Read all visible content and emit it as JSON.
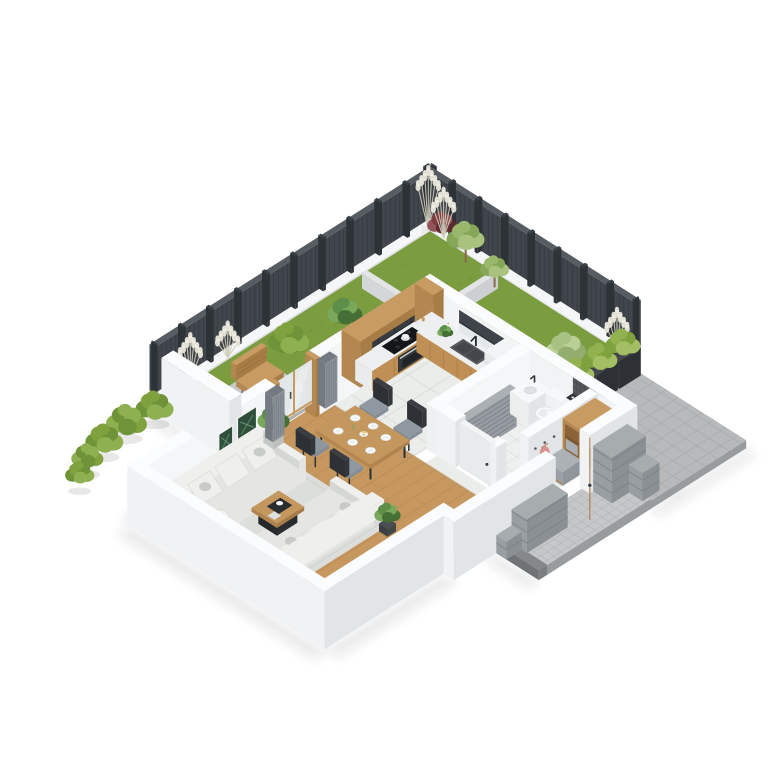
{
  "scene": {
    "description": "isometric-3d-floor-plan-render-of-apartment-with-garden",
    "background": "#ffffff"
  },
  "counts": {
    "fence_nw_posts": 10,
    "fence_ne_posts": 8,
    "garden_boundary_bushes": 5,
    "planter_boxes": 3,
    "dining_plates": 6,
    "dining_chairs": 4,
    "sofas": 2,
    "wall_art_frames": 4
  },
  "palette": {
    "bg": "#ffffff",
    "fenceFace": "#41464c",
    "fenceTop": "#575c62",
    "fencePost": "#2d3237",
    "fenceSlat": "#31363c",
    "curbTop": "#f5f6f7",
    "curbLeft": "#e8eaec",
    "curbRight": "#dbdee1",
    "grass": "#7c9c40",
    "grassDark": "#6d8c36",
    "edging": "#e2e4e6",
    "wallTop": "#fbfcfd",
    "wallLeft": "#f0f2f4",
    "wallRight": "#e2e5e8",
    "woodFloor": "#c6975f",
    "woodLine": "#b0814c",
    "tile": "#ebedeb",
    "tileLine": "#d9dbd8",
    "bathTile": "#eef0f0",
    "patio": "#b7b9bb",
    "patioLine": "#a8aaac",
    "patioSide": "#999c9f",
    "patioDark": "#84888b",
    "walkway": "#c5c7c9",
    "walkLine": "#b5b7b9",
    "wood": "#c89b63",
    "woodDark": "#b3874f",
    "woodDarker": "#a87c45",
    "woodFront": "#c08f55",
    "counterTop": "#edeff0",
    "cabinetDark": "#383c41",
    "cabinetLine": "#292d32",
    "glass": "#e3e9ea",
    "blind": "#3f444a",
    "mosaic": "#55595d",
    "mosaicLine": "#404448",
    "white": "#f7f8f9",
    "washerDoor": "#3b3f43",
    "washerRing": "#82878c",
    "radiator": "#979da2",
    "radiatorLine": "#7b8186",
    "rug": "#dcdedb",
    "rugLine": "#cfd1ce",
    "sofa": "#e5e6e4",
    "sofaLight": "#efefee",
    "sofaShade": "#d5d7d5",
    "cushion": "#c9cbc8",
    "tableWood": "#c4975f",
    "chairSeat": "#8f98a0",
    "chairDark": "#2d3135",
    "lampShade": "#f0f0ee",
    "lampWood": "#b08d5c",
    "greens": [
      "#5d8f4a",
      "#79a85b",
      "#466f36"
    ],
    "treeGreens": [
      "#9ab86b",
      "#86a758",
      "#a9c27e"
    ],
    "hedgeGreens": [
      "#92b14f",
      "#7fa23f",
      "#a4bf63"
    ],
    "bushGreens": [
      "#7fa23f",
      "#6e9338",
      "#8fb050"
    ],
    "paleShrub": [
      "#a8c284",
      "#b9cf96",
      "#93ad6e"
    ],
    "redShrub": [
      "#7e3b41",
      "#93555a",
      "#5f2b33"
    ],
    "pampas": "#e8e6d8",
    "pampasStem": "#cfccba",
    "artGreen": "#2f4f3b",
    "artLeaf": "#6d9a7c",
    "curtain": "#8a9097",
    "curtainDark": "#747a82",
    "doorWood": "#c5965c",
    "blockTop": "#a7acaf",
    "blockLeft": "#999ea2",
    "blockRight": "#8b9094",
    "blockLine": "#7c8185",
    "bag": "#d8918c",
    "bowlYellow": "#e4c768",
    "shadow": "rgba(50,55,60,0.10)"
  },
  "inventory": {
    "garden": [
      "slatted-privacy-fence",
      "lawn-strips",
      "pampas-grasses",
      "red-leaf-shrub",
      "garden-trees",
      "round-boxwood-bushes",
      "garden-bench",
      "paver-patch",
      "planter-boxes-with-hedge",
      "white-curb-wall"
    ],
    "kitchen": [
      "dark-upper-cabinets",
      "wood-cabinet-niche",
      "cooktop-with-pot",
      "oven",
      "sink-with-faucet",
      "window-with-roller-blind",
      "counter-plant",
      "tall-cabinet"
    ],
    "dining": [
      "wooden-dining-table",
      "chairs",
      "plates",
      "fruit-bowl"
    ],
    "living_room": [
      "facing-sofas",
      "coffee-table",
      "area-rug",
      "tripod-floor-lamp",
      "potted-plants",
      "botanical-wall-art",
      "gray-curtains",
      "glass-garden-door"
    ],
    "bathroom": [
      "vanity-sink",
      "toilet",
      "washing-machine",
      "towel-radiator",
      "mosaic-tile-wall",
      "bathroom-door"
    ],
    "entry": [
      "wood-wardrobe-bench",
      "seat-cushion",
      "coat-hooks-with-bag",
      "open-front-door",
      "gray-block-walls",
      "paver-walkway",
      "paver-patio"
    ]
  }
}
